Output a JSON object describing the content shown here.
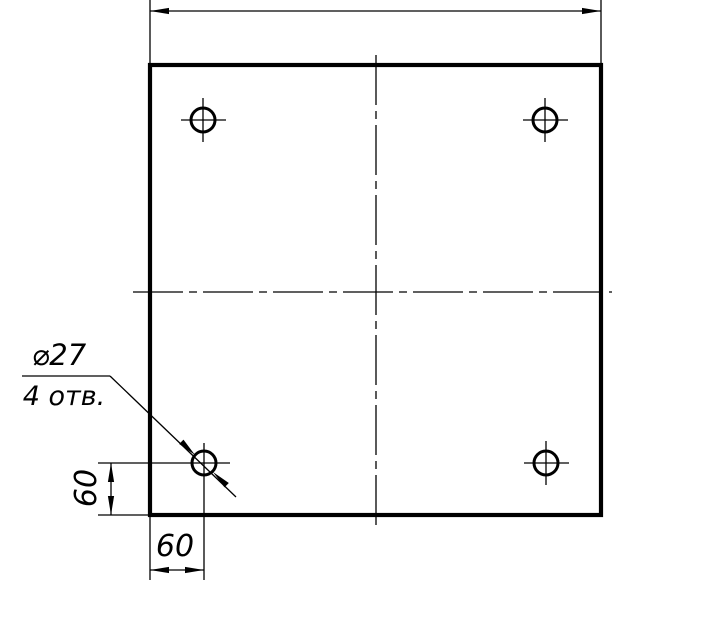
{
  "title": "Square plate with four holes — dimensioned technical drawing",
  "canvas": {
    "width": 713,
    "height": 631,
    "background": "#ffffff",
    "line_color": "#000000"
  },
  "labels": {
    "left_dim": "60",
    "bottom_dim": "60",
    "callout_diameter": "⌀27",
    "callout_count": "4 отв."
  },
  "stroke": {
    "thick": 4.2,
    "medium": 3,
    "thin": 1.3
  },
  "centerline_dash": "50 6 8 6",
  "arrow": {
    "length": 19,
    "half_width": 3.1
  },
  "plate": {
    "x": 150,
    "y": 65,
    "width": 451,
    "height": 450
  },
  "holes": {
    "radius": 12,
    "stroke_width": 3,
    "centers": [
      {
        "id": "top-left",
        "cx": 203,
        "cy": 120
      },
      {
        "id": "top-right",
        "cx": 545,
        "cy": 120
      },
      {
        "id": "bottom-left",
        "cx": 204,
        "cy": 463
      },
      {
        "id": "bottom-right",
        "cx": 546,
        "cy": 463
      }
    ]
  },
  "lines": [
    {
      "name": "extension-line-top-left",
      "x1": 150,
      "y1": 0,
      "x2": 150,
      "y2": 65
    },
    {
      "name": "extension-line-top-right",
      "x1": 601,
      "y1": 0,
      "x2": 601,
      "y2": 65
    },
    {
      "name": "dim-top-line",
      "x1": 150,
      "y1": 11,
      "x2": 601,
      "y2": 11
    },
    {
      "name": "centerline-vertical",
      "x1": 376,
      "y1": 55,
      "x2": 376,
      "y2": 527,
      "dash": true
    },
    {
      "name": "centerline-horizontal",
      "x1": 133,
      "y1": 292,
      "x2": 612,
      "y2": 292,
      "dash": true
    },
    {
      "name": "crosshair-h-top-left",
      "x1": 181,
      "y1": 120,
      "x2": 226,
      "y2": 120
    },
    {
      "name": "crosshair-v-top-left",
      "x1": 203,
      "y1": 98,
      "x2": 203,
      "y2": 142
    },
    {
      "name": "crosshair-h-top-right",
      "x1": 523,
      "y1": 120,
      "x2": 568,
      "y2": 120
    },
    {
      "name": "crosshair-v-top-right",
      "x1": 545,
      "y1": 98,
      "x2": 545,
      "y2": 142
    },
    {
      "name": "crosshair-h-bottom-right",
      "x1": 524,
      "y1": 463,
      "x2": 569,
      "y2": 463
    },
    {
      "name": "crosshair-v-bottom-right",
      "x1": 546,
      "y1": 441,
      "x2": 546,
      "y2": 485
    },
    {
      "name": "crosshair-h-bottom-left",
      "x1": 98,
      "y1": 463,
      "x2": 230,
      "y2": 463
    },
    {
      "name": "crosshair-v-bottom-left",
      "x1": 204,
      "y1": 443,
      "x2": 204,
      "y2": 580
    },
    {
      "name": "extension-line-left-dim-bottom",
      "x1": 98,
      "y1": 515,
      "x2": 150,
      "y2": 515
    },
    {
      "name": "dim-left-line",
      "x1": 111,
      "y1": 463,
      "x2": 111,
      "y2": 515
    },
    {
      "name": "extension-line-bottom-dim-left",
      "x1": 150,
      "y1": 515,
      "x2": 150,
      "y2": 580
    },
    {
      "name": "dim-bottom-line",
      "x1": 150,
      "y1": 570,
      "x2": 204,
      "y2": 570
    },
    {
      "name": "callout-shelf",
      "x1": 22,
      "y1": 376,
      "x2": 110,
      "y2": 376
    },
    {
      "name": "callout-leader",
      "x1": 110,
      "y1": 376,
      "x2": 236,
      "y2": 497
    }
  ],
  "arrows": [
    {
      "name": "dim-top-arrow-left",
      "tip": [
        150,
        11
      ],
      "angle": 180
    },
    {
      "name": "dim-top-arrow-right",
      "tip": [
        601,
        11
      ],
      "angle": 0
    },
    {
      "name": "dim-left-arrow-top",
      "tip": [
        111,
        463
      ],
      "angle": 270
    },
    {
      "name": "dim-left-arrow-bottom",
      "tip": [
        111,
        515
      ],
      "angle": 90
    },
    {
      "name": "dim-bottom-arrow-left",
      "tip": [
        150,
        570
      ],
      "angle": 180
    },
    {
      "name": "dim-bottom-arrow-right",
      "tip": [
        204,
        570
      ],
      "angle": 0
    },
    {
      "name": "callout-arrow-upper",
      "tip": [
        195,
        455
      ],
      "angle": 44
    },
    {
      "name": "callout-arrow-lower",
      "tip": [
        213,
        472
      ],
      "angle": 224
    }
  ],
  "texts": [
    {
      "name": "dim-bottom-label",
      "bind": "labels.bottom_dim",
      "x": 175,
      "y": 556,
      "size": 30
    },
    {
      "name": "dim-left-label",
      "bind": "labels.left_dim",
      "x": 96,
      "y": 488,
      "size": 30,
      "rotate": -90
    },
    {
      "name": "callout-diameter-label",
      "bind": "labels.callout_diameter",
      "x": 59,
      "y": 365,
      "size": 29
    },
    {
      "name": "callout-count-label",
      "bind": "labels.callout_count",
      "x": 64,
      "y": 405,
      "size": 27
    }
  ]
}
